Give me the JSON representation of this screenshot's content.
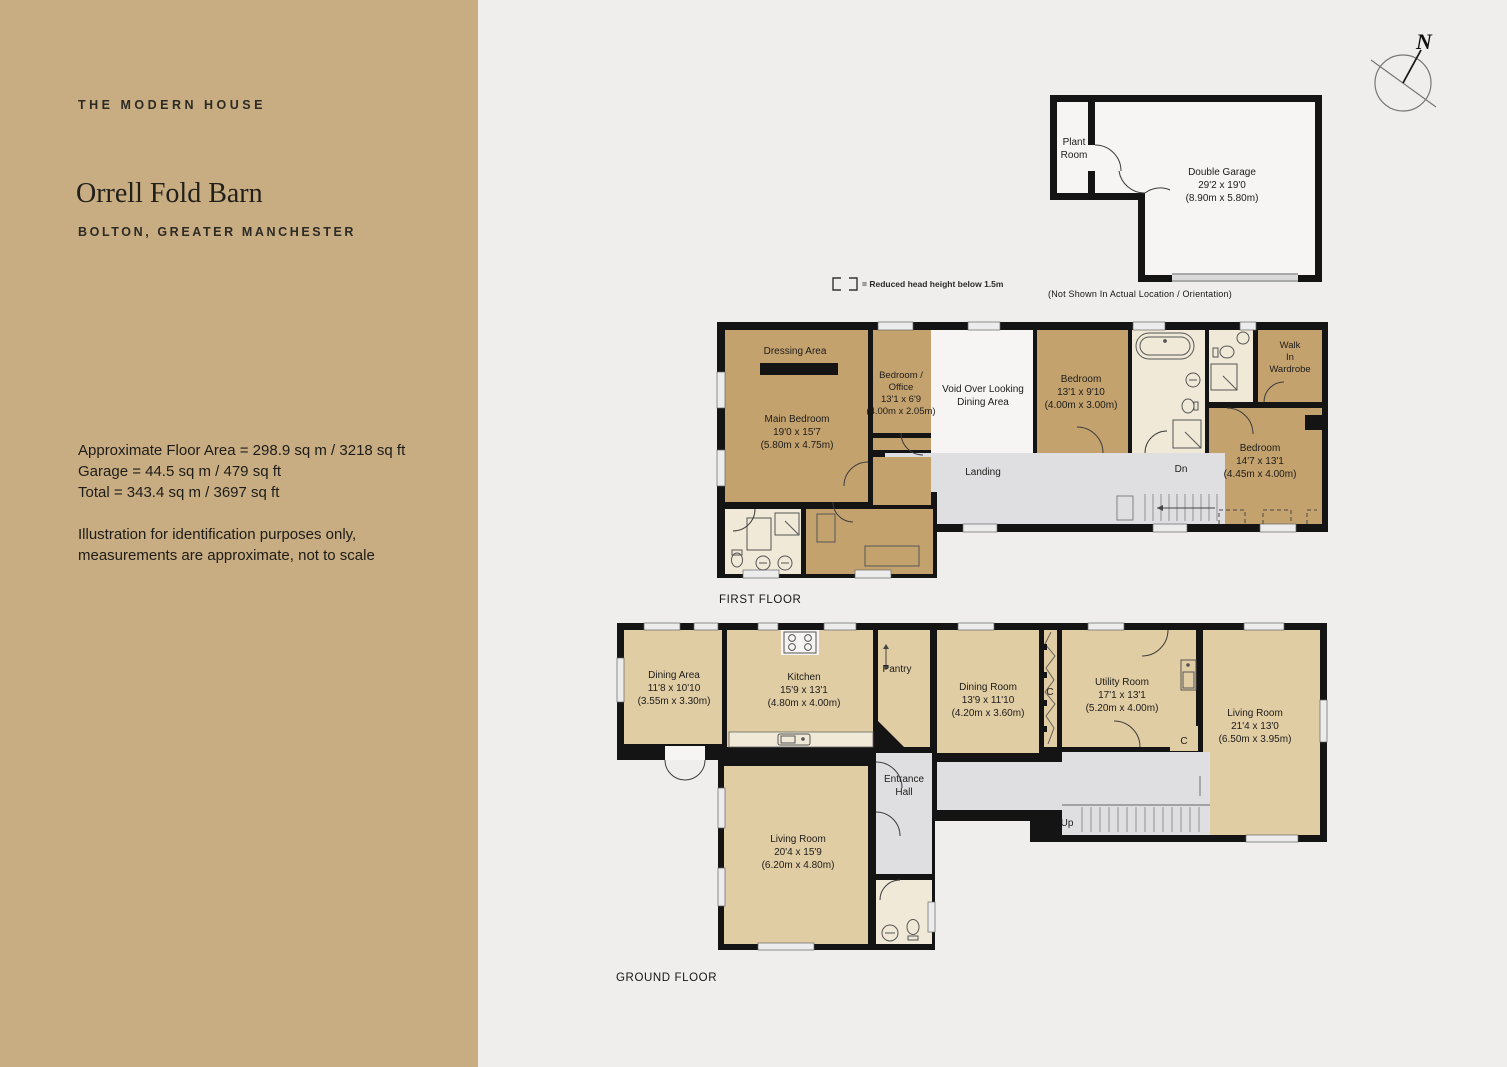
{
  "sidebar": {
    "brand": "THE MODERN HOUSE",
    "title": "Orrell Fold Barn",
    "location": "BOLTON, GREATER MANCHESTER",
    "stats": {
      "line1": "Approximate Floor Area = 298.9 sq m / 3218 sq ft",
      "line2": "Garage = 44.5 sq m / 479 sq ft",
      "line3": "Total = 343.4 sq m / 3697 sq ft"
    },
    "disclaimer": {
      "line1": "Illustration for identification purposes only,",
      "line2": "measurements are approximate, not to scale"
    }
  },
  "legend": {
    "text": "= Reduced head height below 1.5m"
  },
  "compass": {
    "n": "N"
  },
  "garage": {
    "plant1": "Plant",
    "plant2": "Room",
    "name": "Double Garage",
    "ft": "29'2 x 19'0",
    "m": "(8.90m x 5.80m)",
    "note": "(Not Shown In Actual Location / Orientation)"
  },
  "first_floor": {
    "caption": "FIRST FLOOR",
    "dressing": "Dressing Area",
    "main_bedroom": {
      "name": "Main Bedroom",
      "ft": "19'0 x 15'7",
      "m": "(5.80m x 4.75m)"
    },
    "office": {
      "l1": "Bedroom /",
      "l2": "Office",
      "ft": "13'1 x 6'9",
      "m": "(4.00m x 2.05m)"
    },
    "void": {
      "l1": "Void Over Looking",
      "l2": "Dining Area"
    },
    "bedroom2": {
      "name": "Bedroom",
      "ft": "13'1 x 9'10",
      "m": "(4.00m x 3.00m)"
    },
    "landing": "Landing",
    "dn": "Dn",
    "walk_in": {
      "l1": "Walk",
      "l2": "In",
      "l3": "Wardrobe"
    },
    "bedroom3": {
      "name": "Bedroom",
      "ft": "14'7 x 13'1",
      "m": "(4.45m x 4.00m)"
    }
  },
  "ground_floor": {
    "caption": "GROUND FLOOR",
    "dining_area": {
      "name": "Dining Area",
      "ft": "11'8 x 10'10",
      "m": "(3.55m x 3.30m)"
    },
    "kitchen": {
      "name": "Kitchen",
      "ft": "15'9 x 13'1",
      "m": "(4.80m x 4.00m)"
    },
    "pantry": "Pantry",
    "dining_room": {
      "name": "Dining Room",
      "ft": "13'9 x 11'10",
      "m": "(4.20m x 3.60m)"
    },
    "utility": {
      "name": "Utility Room",
      "ft": "17'1 x 13'1",
      "m": "(5.20m x 4.00m)"
    },
    "living_right": {
      "name": "Living Room",
      "ft": "21'4 x 13'0",
      "m": "(6.50m x 3.95m)"
    },
    "living_left": {
      "name": "Living Room",
      "ft": "20'4 x 15'9",
      "m": "(6.20m x 4.80m)"
    },
    "entrance": {
      "l1": "Entrance",
      "l2": "Hall"
    },
    "up": "Up",
    "cupboard1": "C",
    "cupboard2": "C"
  },
  "colors": {
    "sidebar_bg": "#c8ad82",
    "background": "#efeeec",
    "wall": "#141414",
    "room_tan_first_floor": "#c4a26e",
    "room_tan_ground_floor": "#e1cda4",
    "bathroom_cream": "#f0e9d8",
    "hall_grey": "#dfdfe1",
    "void_white": "#f6f5f3"
  }
}
